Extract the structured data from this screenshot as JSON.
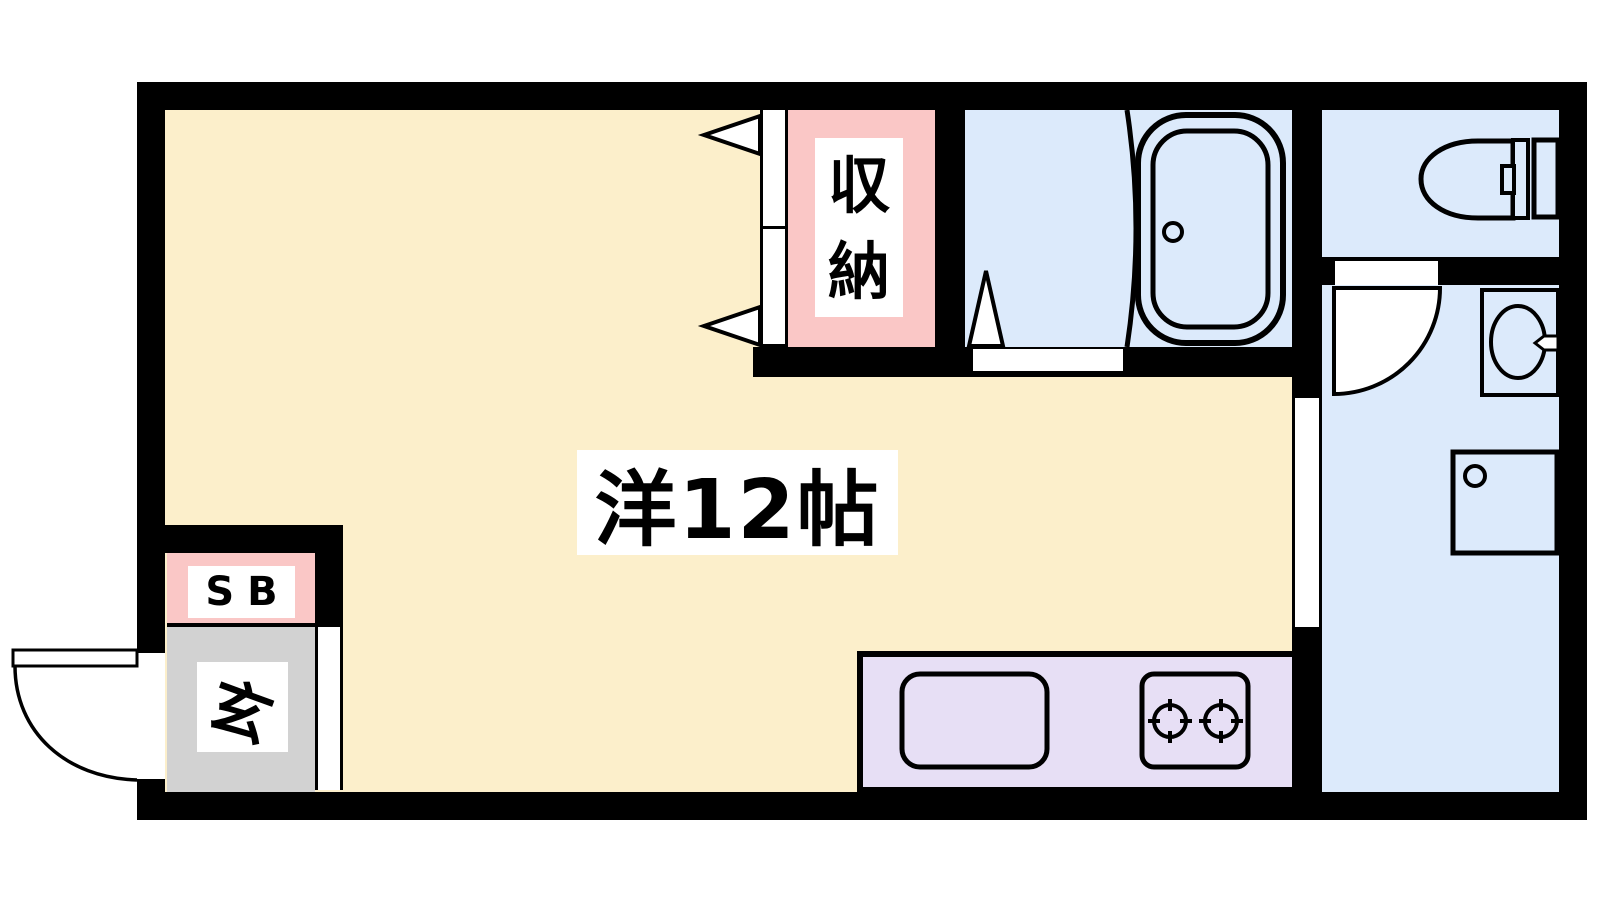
{
  "floor_plan": {
    "rooms": {
      "main_room": {
        "label": "洋12帖",
        "color": "#FCEFCB"
      },
      "closet": {
        "label": "収納",
        "color": "#FAC7C6"
      },
      "shoe_box": {
        "label": "SB",
        "color": "#FAC7C6"
      },
      "entrance": {
        "label": "玄",
        "color": "#D2D2D2"
      },
      "bathroom": {
        "color": "#DCEAFB"
      },
      "toilet_room": {
        "color": "#DCEAFB"
      },
      "washroom": {
        "color": "#DCEAFB"
      },
      "kitchen": {
        "color": "#E7DFF5"
      }
    },
    "wall_color": "#000000",
    "door_color": "#FFFFFF",
    "fixtures": [
      "bathtub-icon",
      "shower-partition",
      "bath-door-triangle",
      "closet-door-arrows",
      "toilet-icon",
      "wash-basin-icon",
      "washing-machine-icon",
      "washroom-door-swing",
      "entry-door-swing",
      "kitchen-sink-icon",
      "two-burner-stove-icon"
    ]
  }
}
